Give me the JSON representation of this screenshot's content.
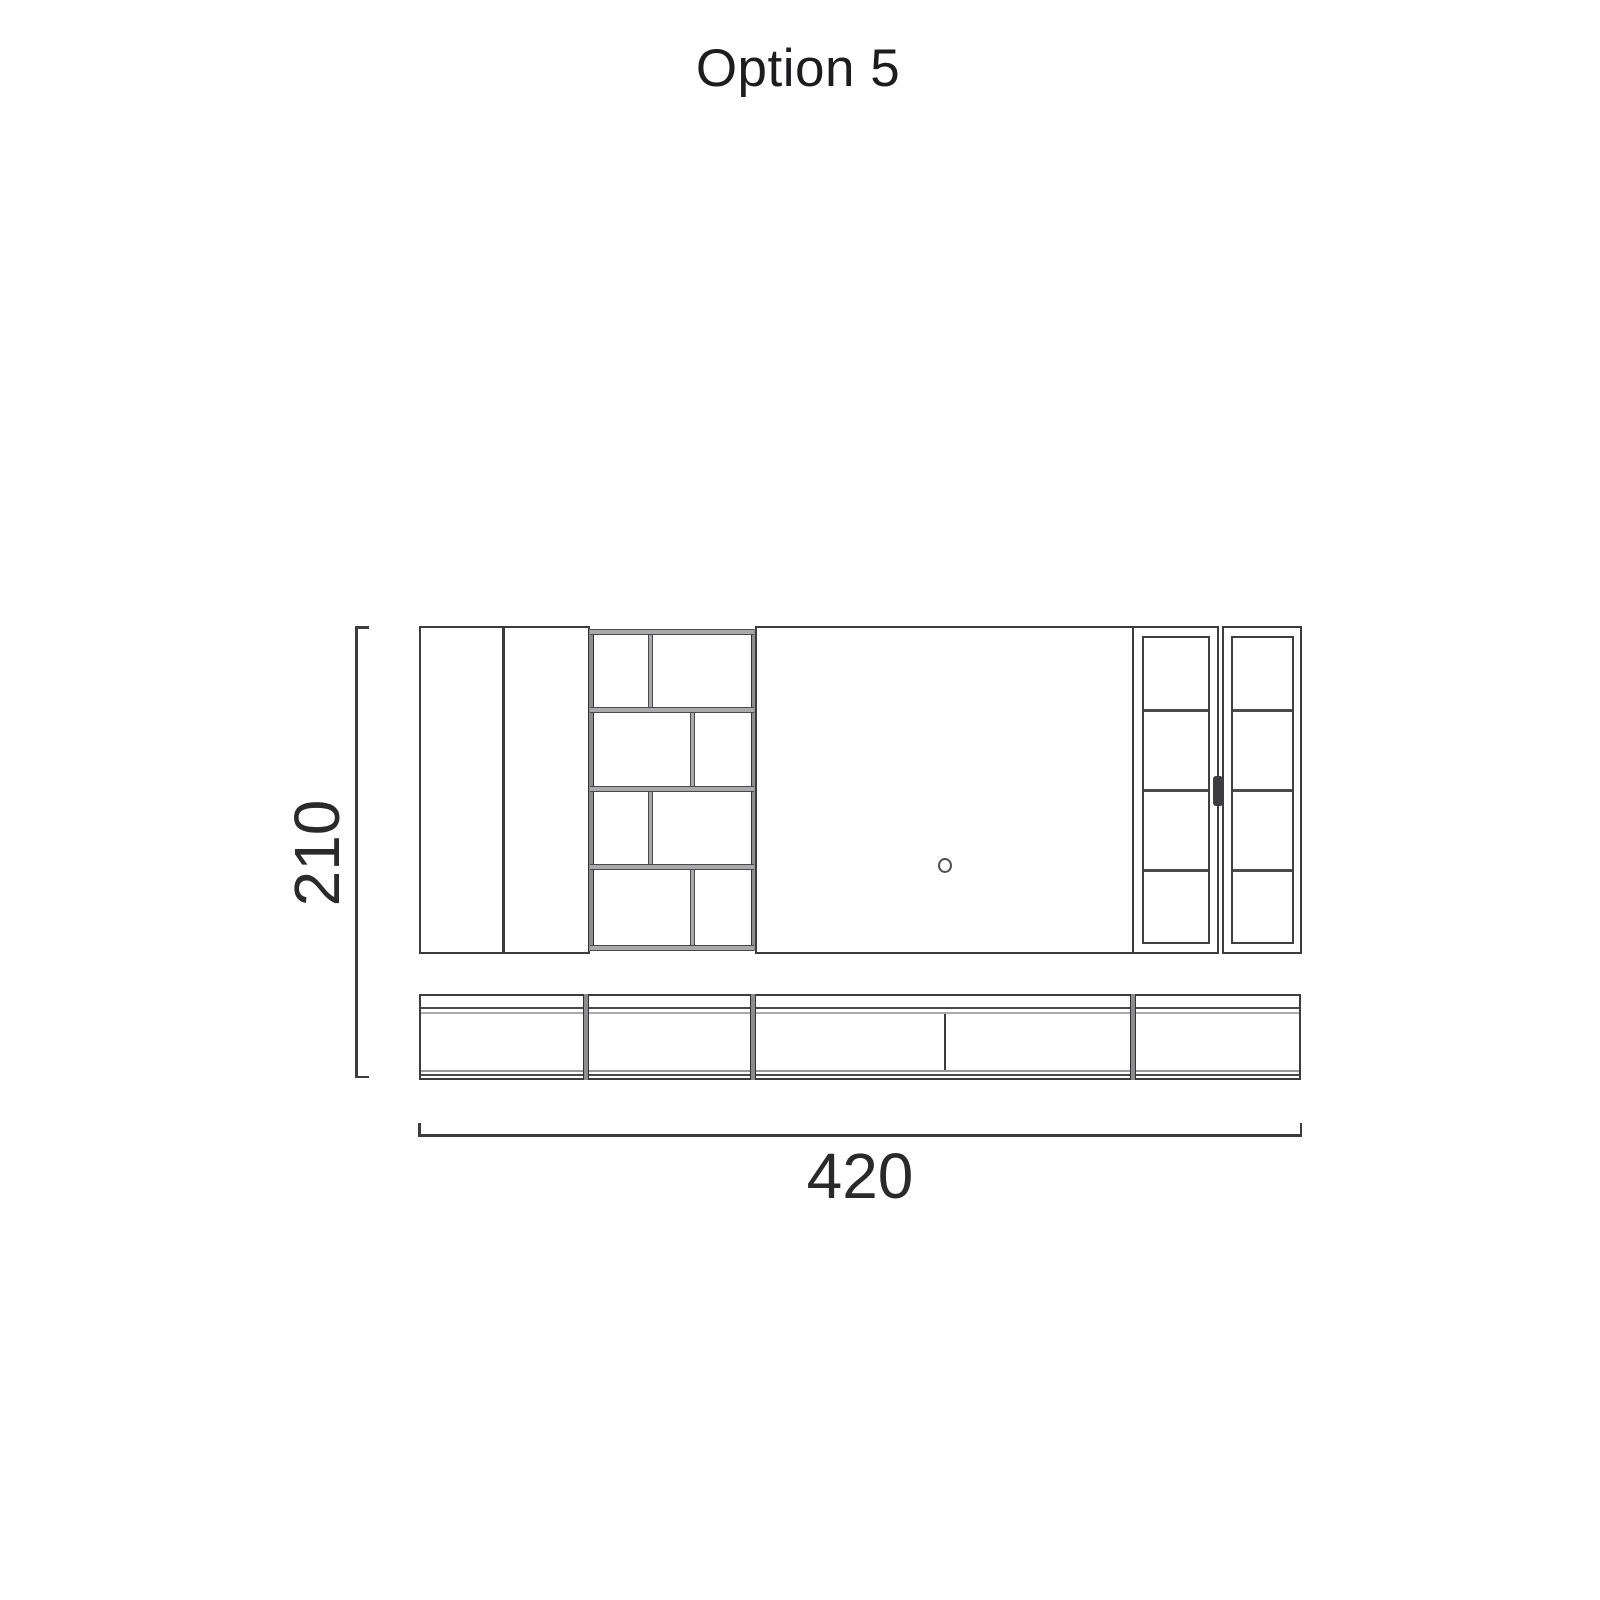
{
  "title": "Option 5",
  "dimensions": {
    "height_label": "210",
    "width_label": "420"
  },
  "drawing": {
    "type": "furniture-elevation",
    "icons": [
      "cable-hole-icon",
      "door-handle-icon"
    ],
    "colors": {
      "line_dark": "#3c3c3e",
      "shelf_gray": "#a9a9ab",
      "post_gray": "#8d8d8f",
      "text": "#2a2a2c",
      "background": "#ffffff"
    }
  }
}
